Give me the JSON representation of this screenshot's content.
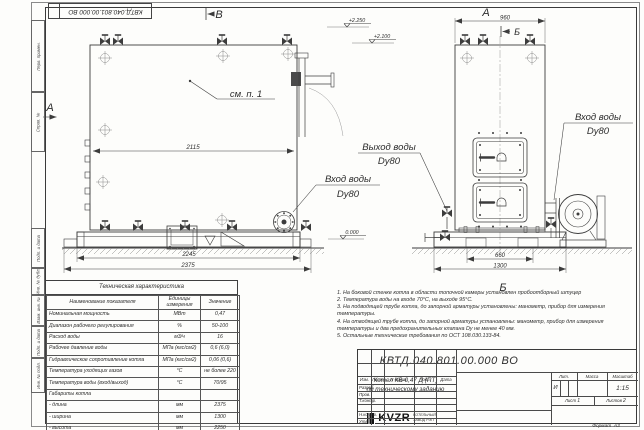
{
  "sheet": {
    "stamp_text": "КВТД.040.801.00.000 ВО",
    "format_label": "Формат",
    "format_value": "А3"
  },
  "margin_labels": {
    "perv": "Перв. примен.",
    "sprav": "Справ. №",
    "podp1": "Подп. и дата",
    "inv_dubl": "Инв. № дубл.",
    "vzam": "Взам. инв. №",
    "podp2": "Подп. и дата",
    "inv_podl": "Инв. № подл."
  },
  "front_view": {
    "view_b": "В",
    "view_a": "А",
    "callout": "см. п. 1",
    "dim_inner": "2115",
    "dim_base": "2245",
    "dim_total": "2375",
    "inlet_label": "Вход воды",
    "inlet_dn": "Dy80",
    "elev1": "+2.250",
    "elev2": "+2.100",
    "elev0": "0.000"
  },
  "side_view": {
    "view_label": "А",
    "dim_top": "960",
    "marker_top": "Б",
    "marker_bottom": "Б",
    "outlet_label": "Выход воды",
    "outlet_dn": "Dy80",
    "inlet_label": "Вход воды",
    "inlet_dn": "Dy80",
    "dim_base": "660",
    "dim_total": "1300"
  },
  "notes": [
    "1.  На боковой стенке котла в области топочной камеры установлен пробоотборный штуцер",
    "2.  Температура воды на входе 70°С, на выходе 95°С.",
    "3.  На подводящей трубе котла, до запорной арматуры установлены: манометр, прибор для измерения температуры.",
    "4.  На отводящей трубе котла, до запорной арматуры установлены: манометр, прибор для измерения температуры и два предохранительных клапана Dу не менее 40 мм.",
    "5.  Остальные технические требования по ОСТ 108.030.133-84."
  ],
  "spec_table": {
    "title": "Техническая характеристика",
    "headers": [
      "Наименование показателя",
      "Единицы измерения",
      "Значение"
    ],
    "rows": [
      [
        "Номинальная мощность",
        "МВт",
        "0,47"
      ],
      [
        "Диапазон рабочего регулирования",
        "%",
        "50-100"
      ],
      [
        "Расход воды",
        "м3/ч",
        "16"
      ],
      [
        "Рабочее давление воды",
        "МПа (кгс/см2)",
        "0,6 (6,0)"
      ],
      [
        "Гидравлическое сопротивление котла",
        "МПа (кгс/см2)",
        "0,06 (0,6)"
      ],
      [
        "Температура уходящих газов",
        "°С",
        "не более 220"
      ],
      [
        "Температура воды (вход/выход)",
        "°С",
        "70/95"
      ],
      [
        "Габариты котла",
        "",
        ""
      ],
      [
        "- длина",
        "мм",
        "2375"
      ],
      [
        "- ширина",
        "мм",
        "1300"
      ],
      [
        "- высота",
        "мм",
        "2250"
      ]
    ]
  },
  "title_block": {
    "doc_number": "КВТД.040.801.00.000  ВО",
    "desc1": "Котел  КВ-0,47 Д (ПТ)",
    "desc2": "по техническому заданию",
    "col_izm": "Изм.",
    "col_list": "Лист",
    "col_ndoc": "N докум.",
    "col_podp": "Подп.",
    "col_data": "Дата",
    "razrab": "Разраб.",
    "prov": "Пров.",
    "tkontr": "Т.контр.",
    "nkontr": "Н.контр.",
    "utv": "Утв.",
    "lit_label": "Лит.",
    "lit_value": "И",
    "massa_label": "Масса",
    "scale_label": "Масштаб",
    "scale_value": "1:15",
    "sheet_label": "Лист",
    "sheet_value": "1",
    "sheets_label": "Листов",
    "sheets_value": "2",
    "logo": "KVZR",
    "company1": "КОТЕЛЬНЫЙ",
    "company2": "ЗАВОД РЭП"
  }
}
